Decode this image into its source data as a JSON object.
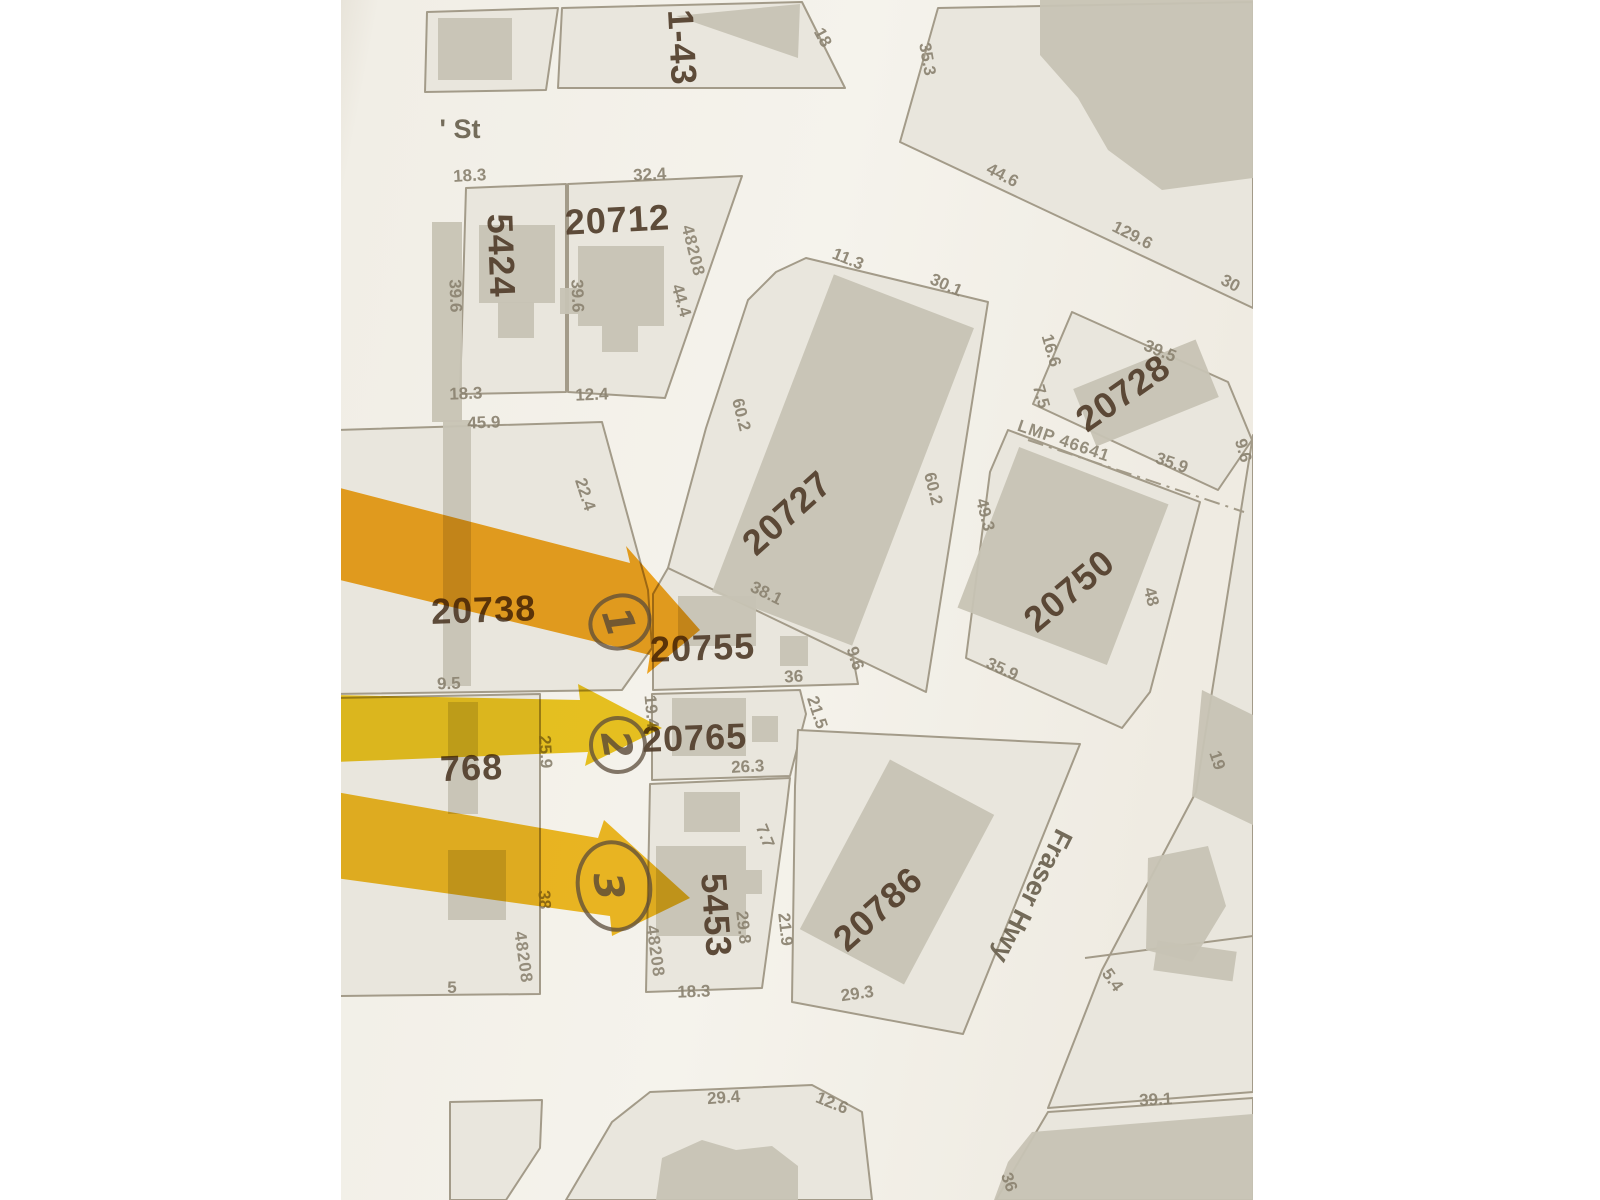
{
  "street_labels": {
    "st": "' St",
    "fraser_hwy": "Fraser Hwy"
  },
  "lots": {
    "l5424": "5424",
    "l20712": "20712",
    "l1_43": "1-43",
    "l20727": "20727",
    "l20728": "20728",
    "l20750": "20750",
    "l20738": "20738",
    "l20755": "20755",
    "l20765": "20765",
    "l5453": "5453",
    "l20786": "20786",
    "l768": "768"
  },
  "plan_numbers": {
    "p48208_20712": "48208",
    "p48208_5453": "48208",
    "p48208_left": "48208",
    "lmp": "LMP 46641"
  },
  "dimensions": {
    "d01": "18.3",
    "d02": "32.4",
    "d03": "39.6",
    "d04": "39.6",
    "d05": "18.3",
    "d06": "12.4",
    "d07": "44.4",
    "d08": "18",
    "d09": "35.3",
    "d10": "44.6",
    "d11": "129.6",
    "d12": "30",
    "d13": "11.3",
    "d14": "30.1",
    "d15": "60.2",
    "d16": "60.2",
    "d17": "49.3",
    "d18": "16.6",
    "d19": "7.5",
    "d20": "39.5",
    "d21": "35.9",
    "d22": "9.6",
    "d23": "35.9",
    "d24": "48",
    "d25": "45.9",
    "d26": "22.4",
    "d27": "9.5",
    "d28": "19.4",
    "d29": "38.1",
    "d30": "36",
    "d31": "9.6",
    "d32": "21.5",
    "d33": "26.3",
    "d34": "7.7",
    "d35": "29.8",
    "d36": "21.9",
    "d37": "18.3",
    "d38": "29.3",
    "d39": "29.4",
    "d40": "12.6",
    "d41": "5",
    "d42": "25.9",
    "d43": "38",
    "d44": "39.1",
    "d45": "19",
    "d46": "5.4",
    "d47": "36"
  },
  "annotations": {
    "circled_numbers": {
      "c1": "1",
      "c2": "2",
      "c3": "3"
    },
    "arrow_colors": {
      "a1": "#f5a40f",
      "a2": "#eec40a",
      "a3": "#f2b70c"
    }
  },
  "colors": {
    "paper": "#f2efe8",
    "lot_fill": "#e9e6dd",
    "building_fill": "#c7c3b4",
    "parcel_line": "#a39b89",
    "lot_text": "#523e2c",
    "dim_text": "#8c8472",
    "ink": "#5b4b3a"
  }
}
